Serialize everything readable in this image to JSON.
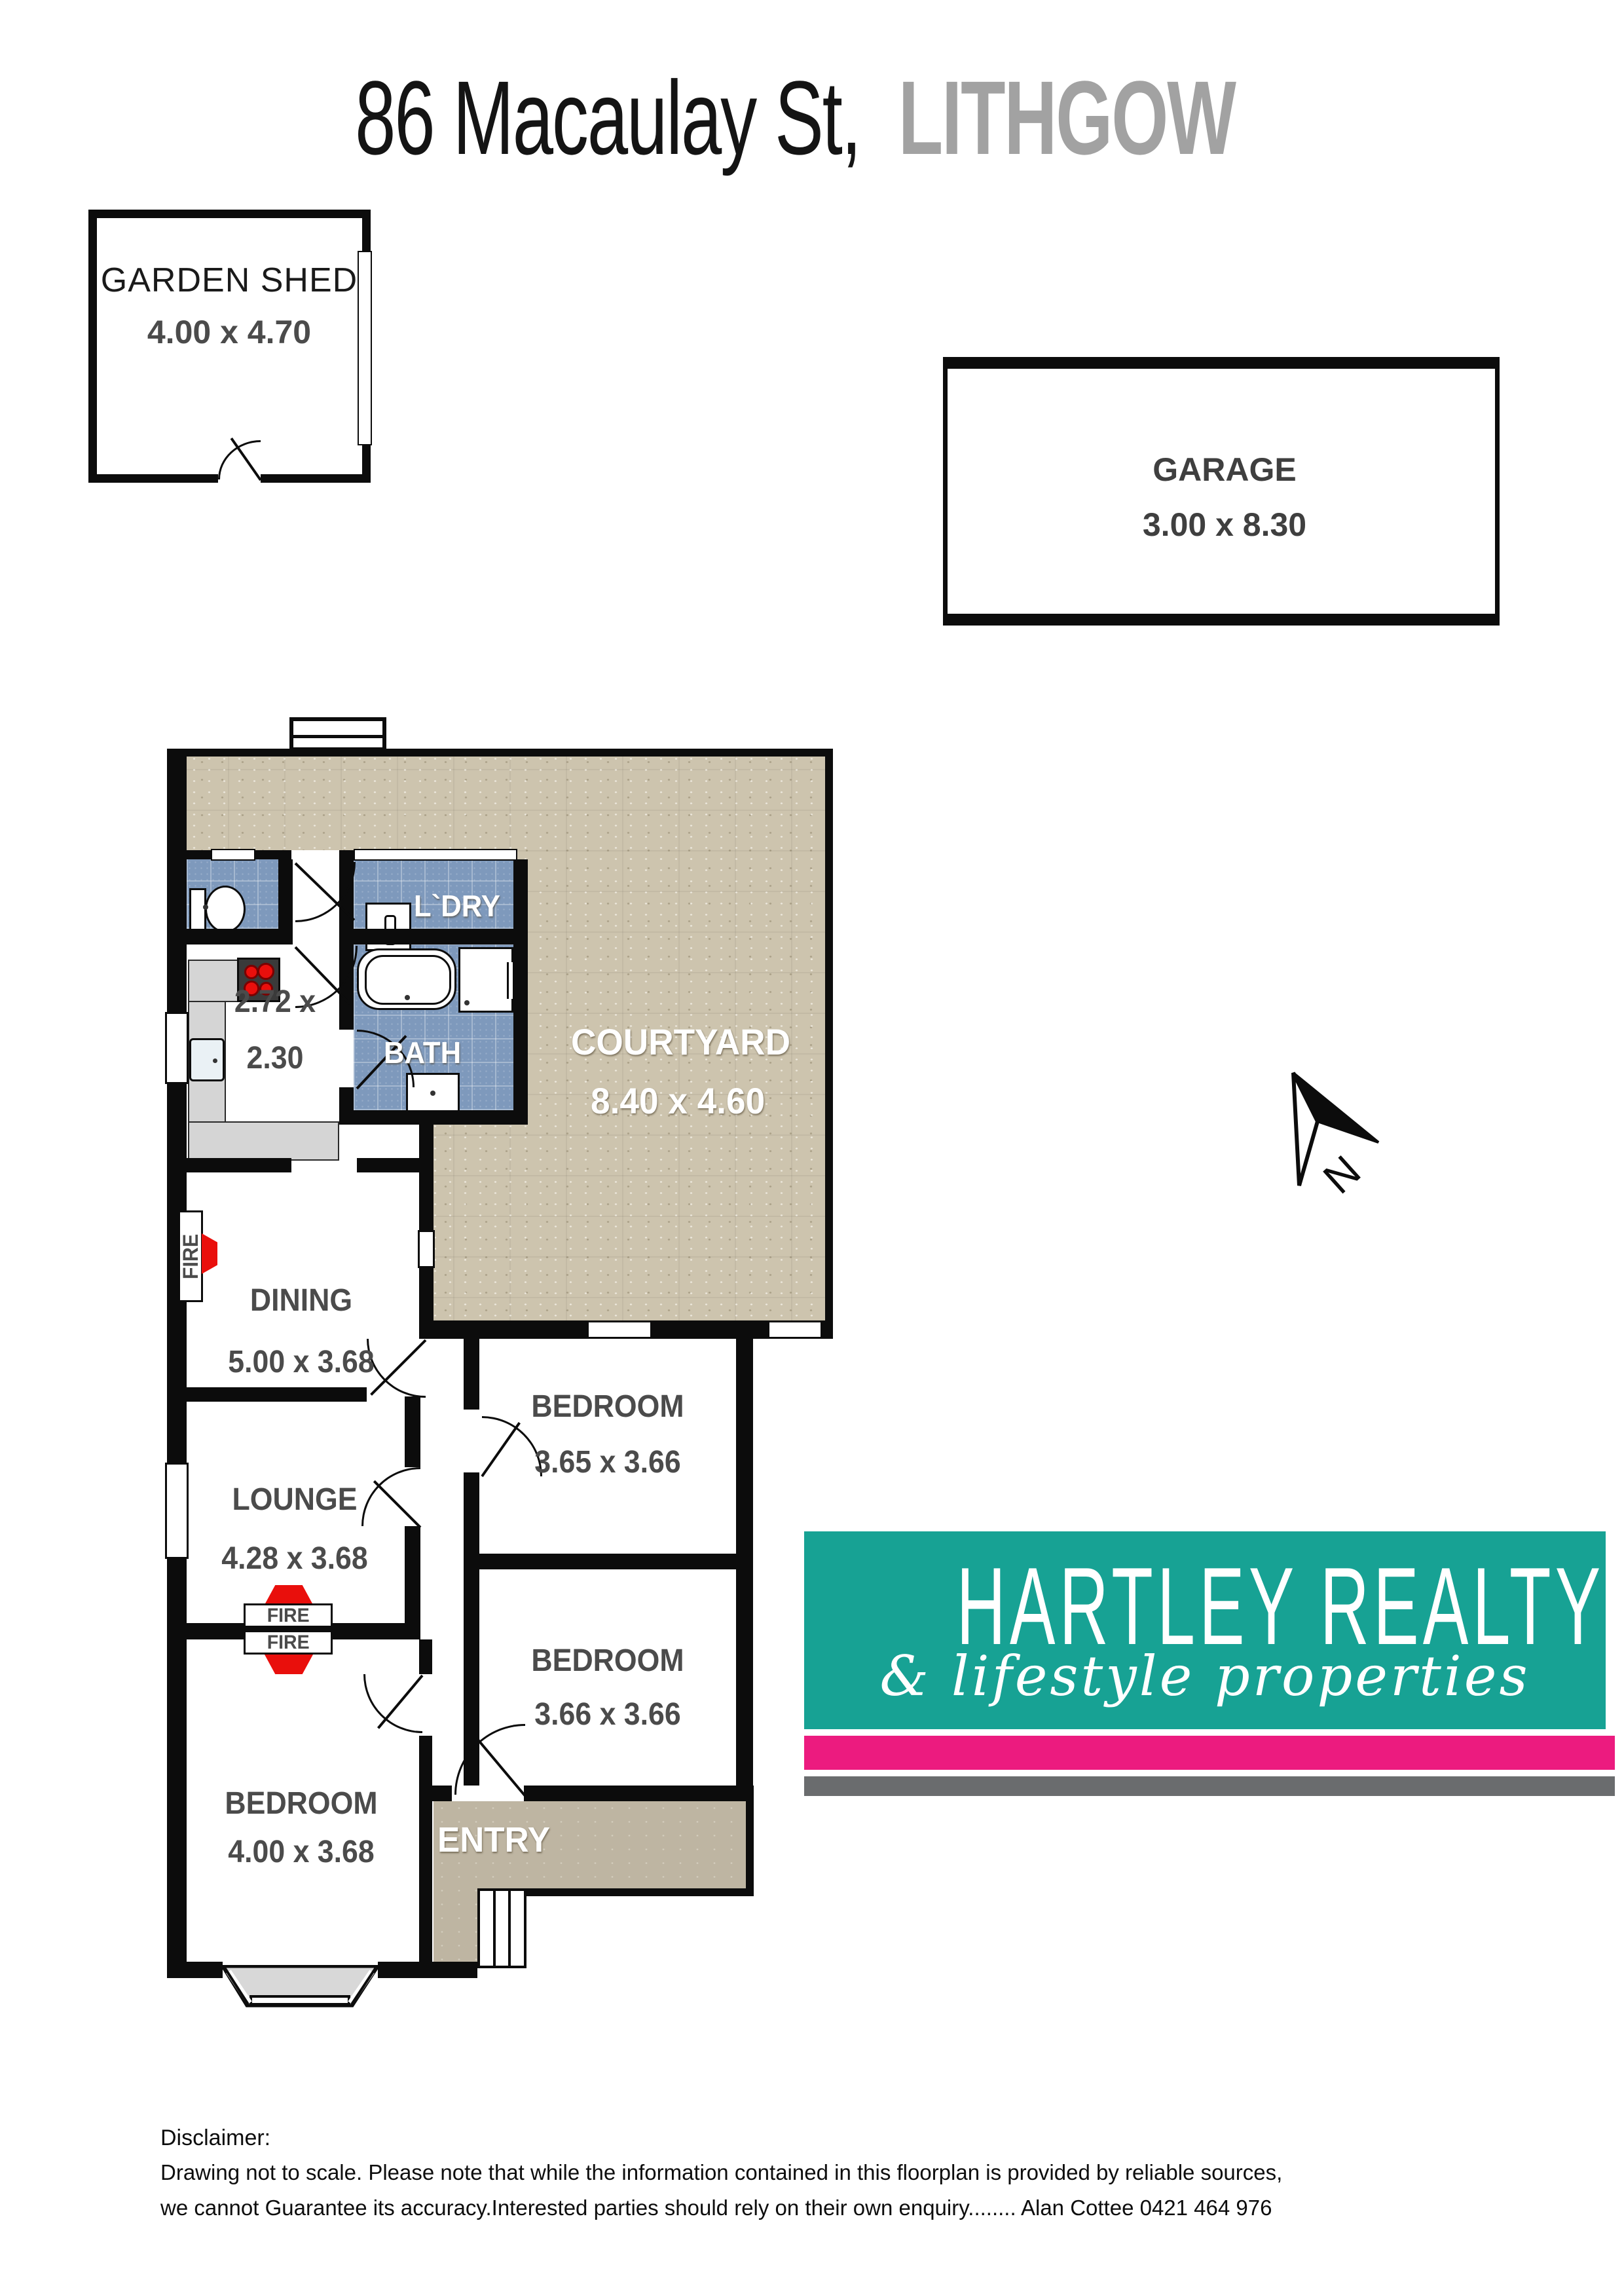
{
  "title": {
    "address": "86 Macaulay St,",
    "suburb": "LITHGOW"
  },
  "outbuildings": {
    "garden_shed": {
      "name": "GARDEN SHED",
      "dims": "4.00 x 4.70"
    },
    "garage": {
      "name": "GARAGE",
      "dims": "3.00 x 8.30"
    }
  },
  "rooms": {
    "laundry": {
      "name": "L`DRY"
    },
    "bath": {
      "name": "BATH"
    },
    "kitchen": {
      "dims_line1": "2.72 x",
      "dims_line2": "2.30"
    },
    "courtyard": {
      "name": "COURTYARD",
      "dims": "8.40 x 4.60"
    },
    "dining": {
      "name": "DINING",
      "dims": "5.00 x 3.68"
    },
    "lounge": {
      "name": "LOUNGE",
      "dims": "4.28 x 3.68"
    },
    "bedroom_top": {
      "name": "BEDROOM",
      "dims": "3.65 x 3.66"
    },
    "bedroom_mid": {
      "name": "BEDROOM",
      "dims": "3.66 x 3.66"
    },
    "bedroom_bottom": {
      "name": "BEDROOM",
      "dims": "4.00 x 3.68"
    },
    "entry": {
      "name": "ENTRY"
    }
  },
  "fireplace_label": "FIRE",
  "compass": {
    "label": "N"
  },
  "logo": {
    "name_line": "HARTLEY REALTY",
    "tagline": "& lifestyle properties",
    "teal": "#17A294",
    "pink": "#EC1B7F",
    "gray": "#6A6C6E"
  },
  "disclaimer": {
    "heading": "Disclaimer:",
    "line1": "Drawing not to scale. Please note that while the information contained in this floorplan is provided by reliable sources,",
    "line2": "we cannot Guarantee its accuracy.Interested parties should rely on their own enquiry........ Alan Cottee 0421 464 976"
  }
}
